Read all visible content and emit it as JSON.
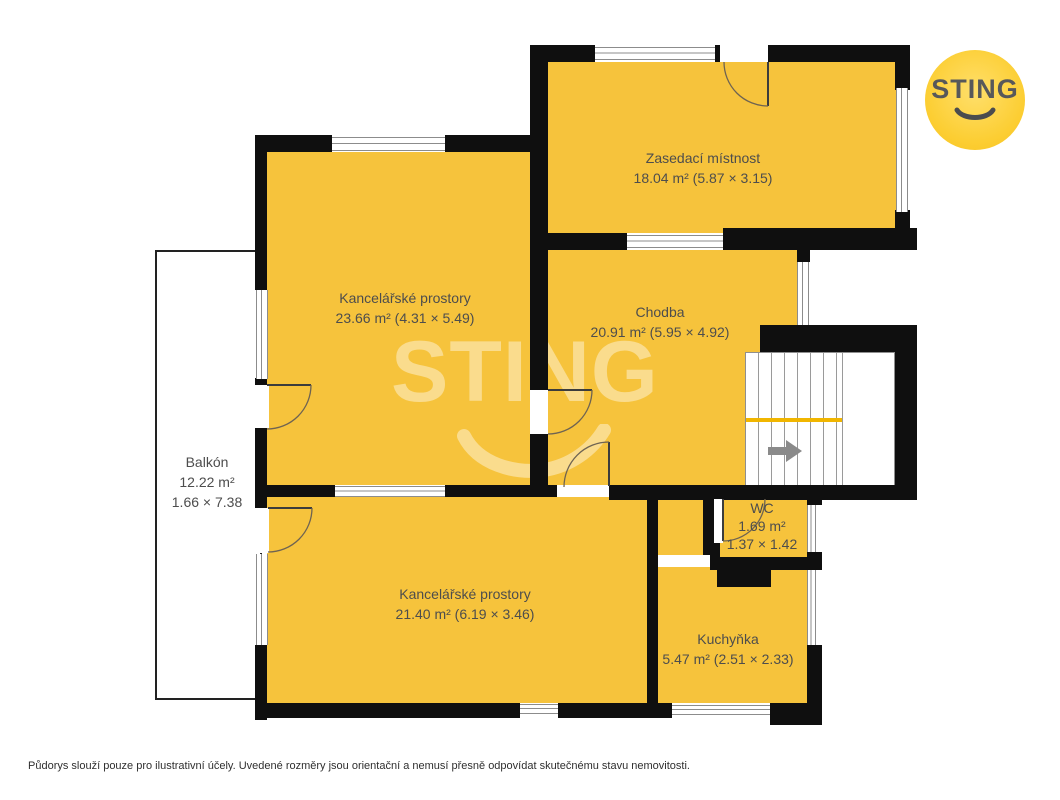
{
  "branding": {
    "logo_text": "STING",
    "watermark_text": "STING"
  },
  "plan": {
    "rooms": {
      "meeting": {
        "name": "Zasedací místnost",
        "detail": "18.04 m² (5.87 × 3.15)"
      },
      "office_top": {
        "name": "Kancelářské prostory",
        "detail": "23.66 m² (4.31 × 5.49)"
      },
      "hall": {
        "name": "Chodba",
        "detail": "20.91 m² (5.95 × 4.92)"
      },
      "balcony": {
        "name": "Balkón",
        "detail": "12.22 m²",
        "dims": "1.66 × 7.38"
      },
      "office_bottom": {
        "name": "Kancelářské prostory",
        "detail": "21.40 m² (6.19 × 3.46)"
      },
      "wc": {
        "name": "WC",
        "detail": "1.69 m²",
        "dims": "1.37 × 1.42"
      },
      "kitchen": {
        "name": "Kuchyňka",
        "detail": "5.47 m² (2.51 × 2.33)"
      }
    }
  },
  "colors": {
    "room_fill": "#F6C33C",
    "wall": "#0F0F0F",
    "logo_yellow": "#FBC926",
    "logo_text": "#57585A",
    "label_text": "#4D4D4D",
    "stair_divider": "#F1B600",
    "watermark": "rgba(255,255,255,0.42)"
  },
  "footer": {
    "disclaimer": "Půdorys slouží pouze pro ilustrativní účely. Uvedené rozměry jsou orientační a nemusí přesně odpovídat skutečnému stavu nemovitosti."
  }
}
